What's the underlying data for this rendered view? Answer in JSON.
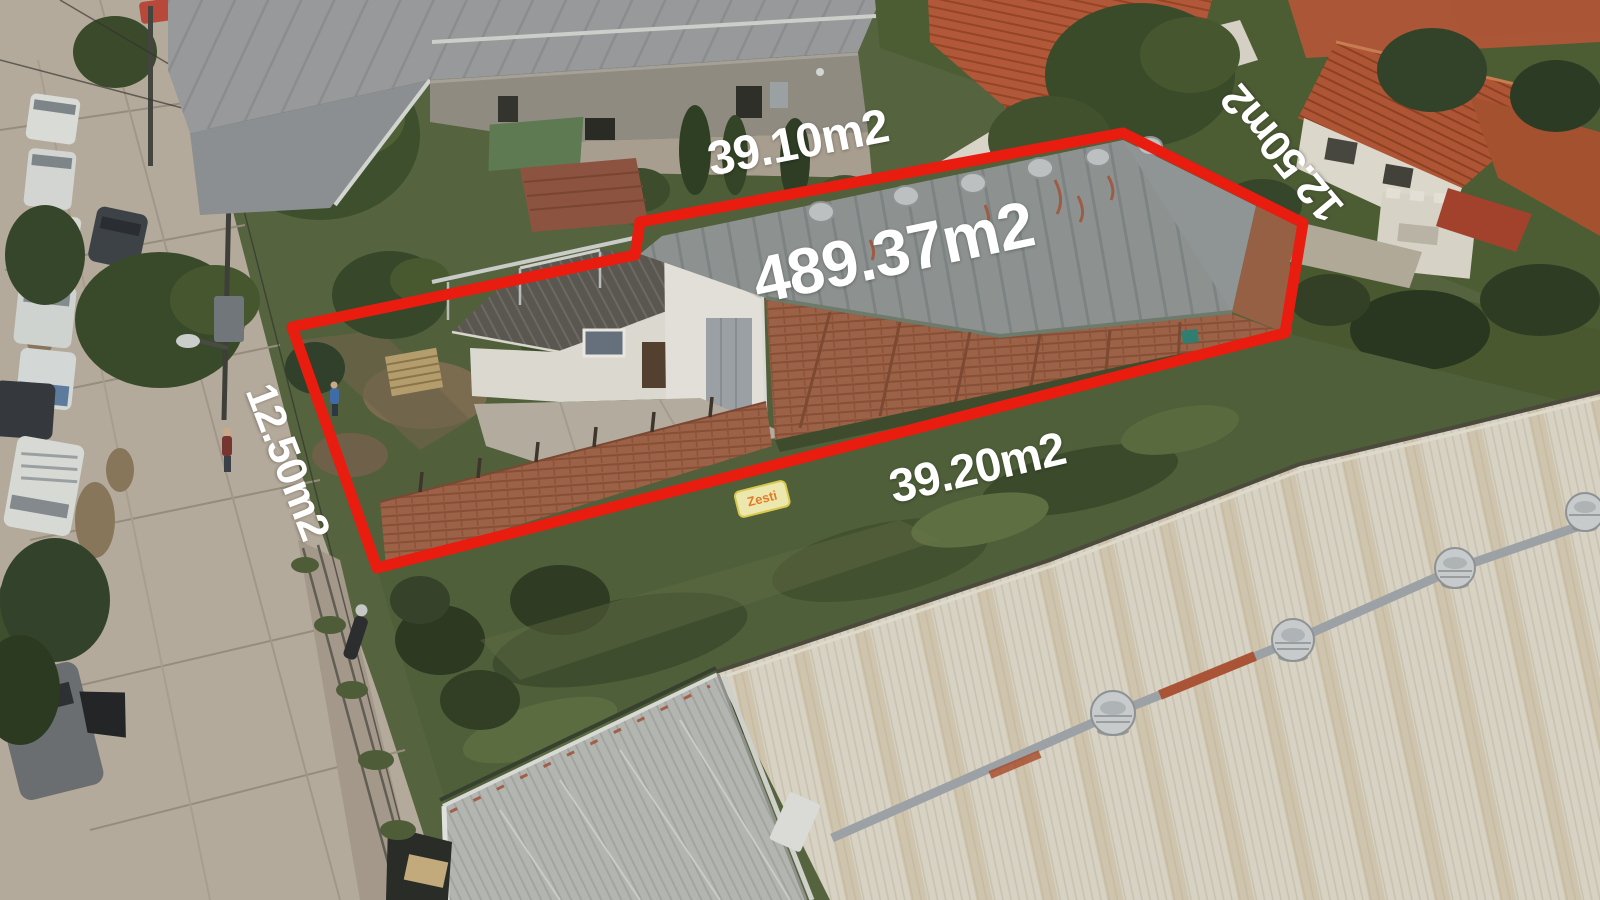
{
  "photo": {
    "type": "aerial-drone-photo",
    "subject": "property lot outlined in red with area measurements",
    "boundary_color": "#e81d10",
    "label_text_color": "#ffffff"
  },
  "labels": {
    "total_area": "489.37m2",
    "top_side": "39.10m2",
    "bottom_side": "39.20m2",
    "left_side": "12.50m2",
    "right_side": "12.50m2"
  },
  "ground_text": {
    "bag_brand": "Zesti"
  }
}
